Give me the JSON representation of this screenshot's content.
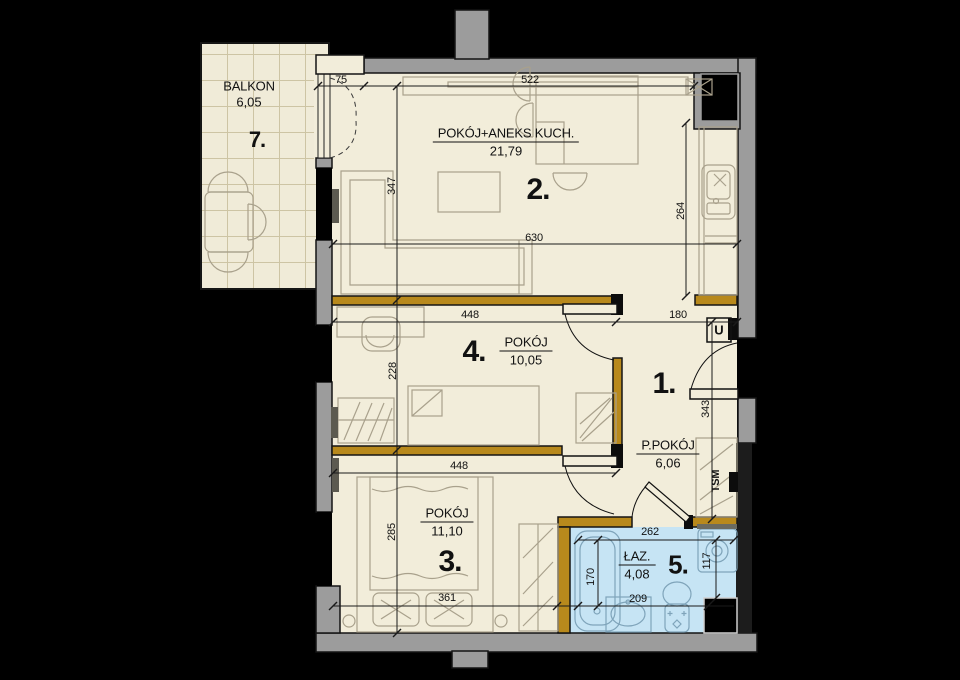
{
  "title": "apartment floor plan",
  "colors": {
    "background": "#000000",
    "exterior_wall": "#9c9c9c",
    "partition_wall": "#b8891c",
    "floor": "#f2edda",
    "bathroom_floor": "#c6e4f4",
    "furniture_line": "#a9a18c"
  },
  "rooms": [
    {
      "id": "living-kitchen",
      "number": "2.",
      "name": "POKÓJ+ANEKS KUCH.",
      "area": "21,79"
    },
    {
      "id": "bedroom-small",
      "number": "4.",
      "name": "POKÓJ",
      "area": "10,05"
    },
    {
      "id": "bedroom",
      "number": "3.",
      "name": "POKÓJ",
      "area": "11,10"
    },
    {
      "id": "hall",
      "number": "1.",
      "name": "P.POKÓJ",
      "area": "6,06"
    },
    {
      "id": "bathroom",
      "number": "5.",
      "name": "ŁAZ.",
      "area": "4,08"
    },
    {
      "id": "balcony",
      "number": "7.",
      "name": "BALKON",
      "area": "6,05"
    }
  ],
  "annotations": {
    "wardrobe_shaft": "TSM",
    "entry_unit": "U"
  },
  "dims": {
    "d75": "75",
    "d522": "522",
    "d630": "630",
    "d347": "347",
    "d264": "264",
    "d448a": "448",
    "d180": "180",
    "d228": "228",
    "d343": "343",
    "d448b": "448",
    "d285": "285",
    "d361": "361",
    "d262": "262",
    "d170": "170",
    "d209": "209",
    "d117": "117"
  }
}
